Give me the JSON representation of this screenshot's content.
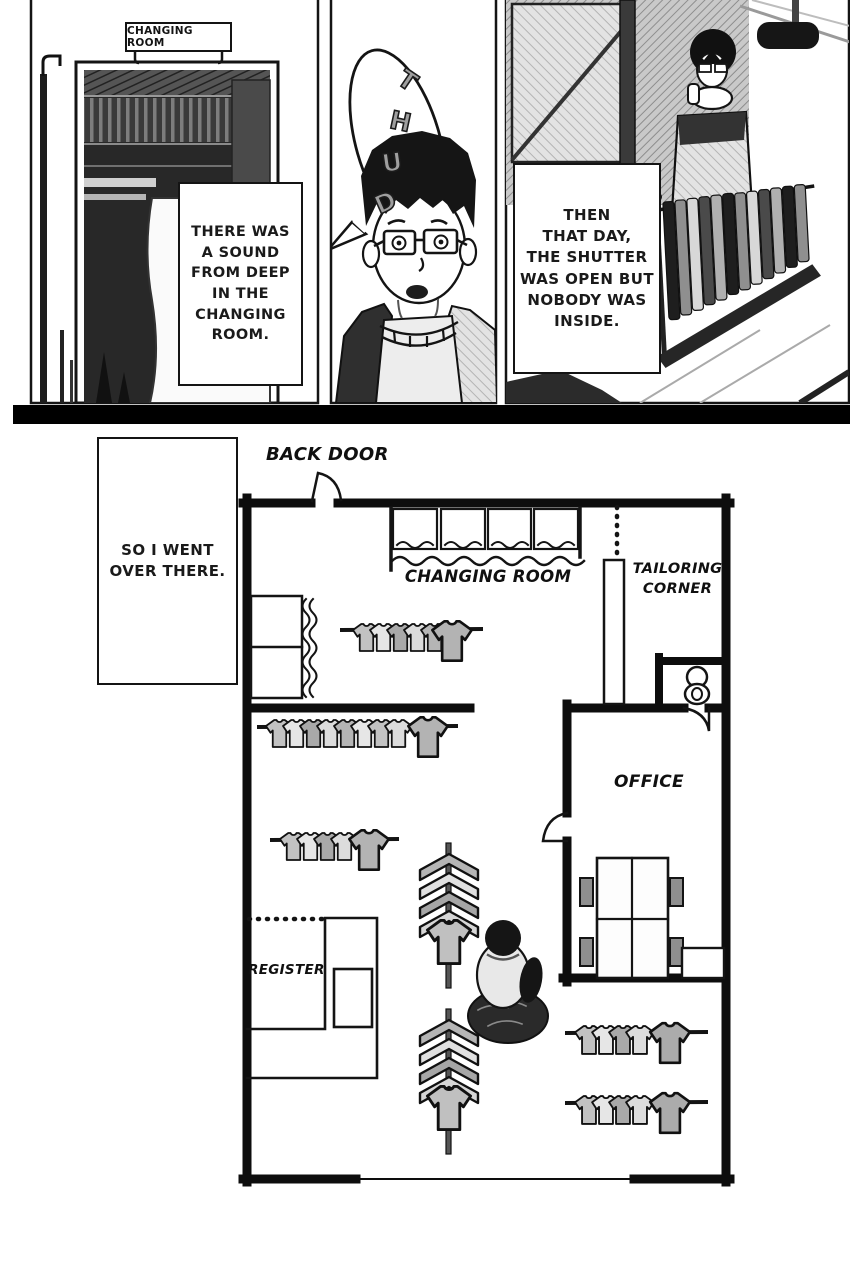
{
  "panel1": {
    "sign_label": "CHANGING ROOM",
    "caption_lines": [
      "THERE WAS",
      "A SOUND",
      "FROM DEEP",
      "IN THE",
      "CHANGING",
      "ROOM."
    ]
  },
  "panel2": {
    "sfx_letters": [
      "T",
      "H",
      "U",
      "D"
    ]
  },
  "panel3": {
    "caption_lines": [
      "THEN",
      "THAT DAY,",
      "THE SHUTTER",
      "WAS OPEN BUT",
      "NOBODY WAS",
      "INSIDE."
    ]
  },
  "floorplan": {
    "caption_lines": [
      "SO I WENT",
      "OVER THERE."
    ],
    "labels": {
      "back_door": "BACK DOOR",
      "changing_room": "CHANGING ROOM",
      "tailoring_line1": "TAILORING",
      "tailoring_line2": "CORNER",
      "office": "OFFICE",
      "register": "REGISTER"
    }
  },
  "colors": {
    "ink": "#141414",
    "paper": "#ffffff",
    "wall_black": "#0d0d0d",
    "shirt_gray": "#bdbdbd"
  }
}
